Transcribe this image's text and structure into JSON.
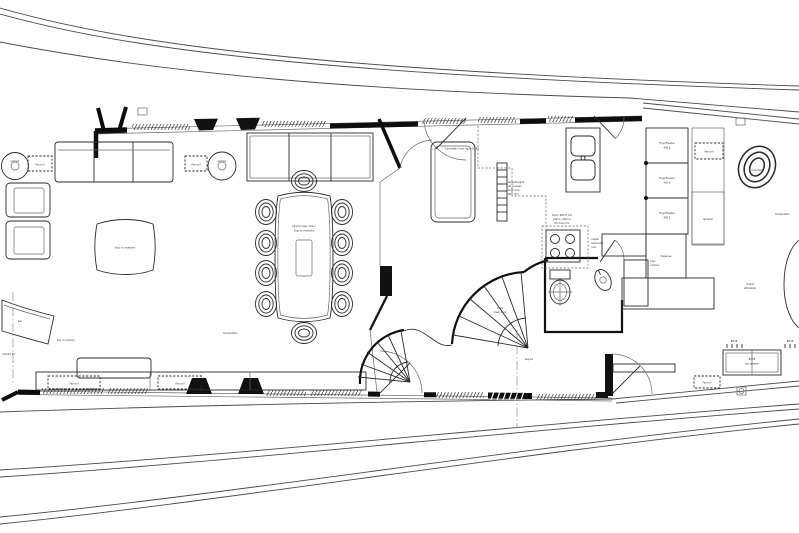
{
  "colors": {
    "line": "#2b2b2b",
    "wall_black": "#111111",
    "hull_gray": "#4a4a4a",
    "background": "#ffffff"
  },
  "labels": {
    "fancoil": "Fancoil",
    "wet_bar": "wet bar",
    "coffee_table": "top in marble",
    "tv_cabinet": "mobile TV",
    "tv_cabinet_top": "top in marble",
    "bar_unit": "bar",
    "dining_table": [
      "tavolo per dieci",
      "top in marble"
    ],
    "moquette": "moquette",
    "sopra": "sopra",
    "sink_note": "Ceramtec liner ligne LT 90",
    "dishwasher_note": [
      "lavastoviglie",
      "da incasso",
      "sotto top",
      "600 mm"
    ],
    "cooktop_note": [
      "forno 900 E CO",
      "piano cottura",
      "filo top mm"
    ],
    "hood_note": [
      "cappa",
      "aspirante",
      "inox"
    ],
    "fridge_units": [
      {
        "line1": "Frigo/Freezer",
        "line2": "400 lt"
      },
      {
        "line1": "Frigo/Freezer",
        "line2": "400 lt"
      },
      {
        "line1": "Frigo/Freezer",
        "line2": "400 lt"
      }
    ],
    "crew_note": [
      "frigo",
      "cantina"
    ],
    "stairs_note": [
      "scala",
      "lower deck"
    ],
    "armchair": "armchair",
    "pantry": "dispensa",
    "wardrobe": "armadio",
    "equipped_unit": [
      "mobile",
      "attrezzato"
    ],
    "speaker_cabinet": [
      "BOSE",
      "top speaker"
    ],
    "speaker_tick": "BOSE"
  }
}
